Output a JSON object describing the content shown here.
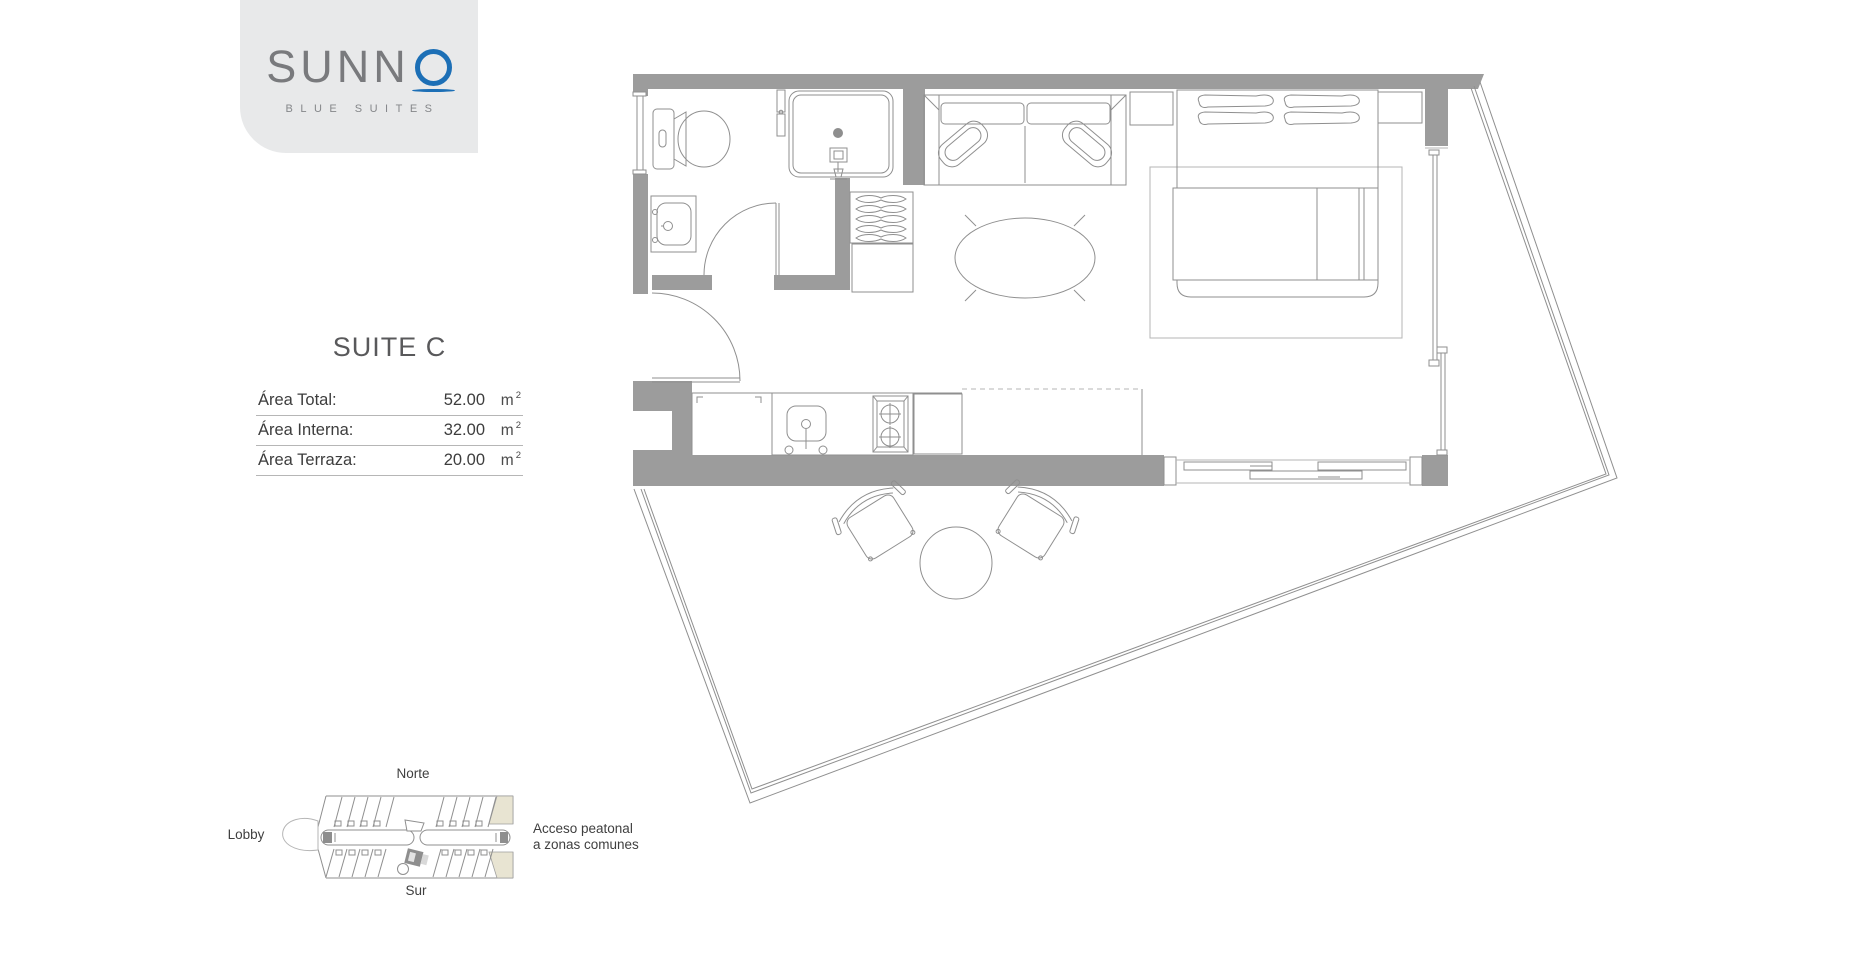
{
  "brand": {
    "name": "SUNN",
    "o_letter": "O",
    "tagline": "BLUE SUITES"
  },
  "suite": {
    "title": "SUITE C",
    "areas": [
      {
        "label": "Área Total:",
        "value": "52.00",
        "unit": "m",
        "unit_sup": "2"
      },
      {
        "label": "Área Interna:",
        "value": "32.00",
        "unit": "m",
        "unit_sup": "2"
      },
      {
        "label": "Área Terraza:",
        "value": "20.00",
        "unit": "m",
        "unit_sup": "2"
      }
    ]
  },
  "locator": {
    "north": "Norte",
    "south": "Sur",
    "lobby": "Lobby",
    "access_line1": "Acceso peatonal",
    "access_line2": "a zonas comunes"
  },
  "colors": {
    "brand_blue": "#1c6fb6",
    "wall_gray": "#9c9c9c",
    "beige": "#e8e4d2",
    "text_dark": "#3f3f3f"
  }
}
